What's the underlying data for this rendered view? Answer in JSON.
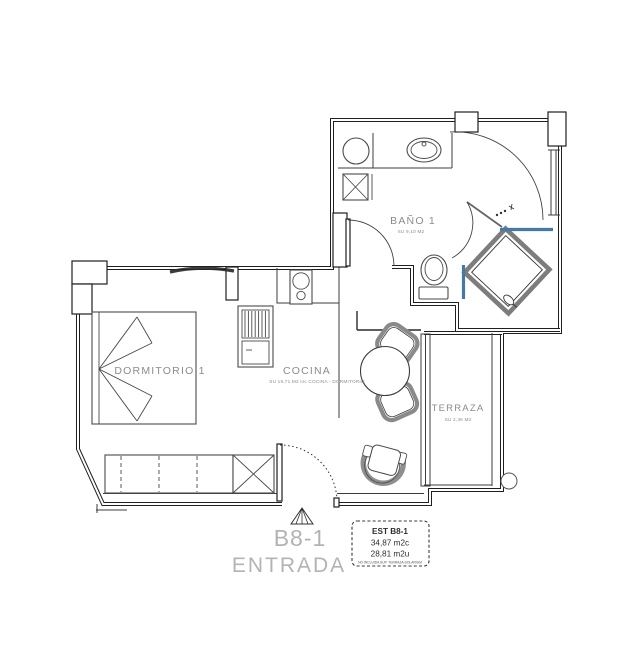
{
  "rooms": {
    "bano": {
      "name": "BAÑO 1",
      "area": "SU 9,10 M2"
    },
    "dormitorio": {
      "name": "DORMITORIO 1"
    },
    "cocina": {
      "name": "COCINA",
      "area": "SU 19,71 M2 inc COCINA - DORMITORIO"
    },
    "terraza": {
      "name": "TERRAZA",
      "area": "SU 2,36 M2"
    }
  },
  "entrance": {
    "unit": "B8-1",
    "label": "ENTRADA"
  },
  "info_box": {
    "title": "EST B8-1",
    "built_area": "34,87 m2c",
    "usable_area": "28,81 m2u",
    "note": "NO INCLUIDA SUP. TERRAZA-SOLARIUM"
  },
  "colors": {
    "wall": "#1f1f1f",
    "glass_blue": "#4479a8",
    "furniture_gray": "#8a8a8a",
    "label_gray": "#8c8c8c",
    "entrance_gray": "#b3b3b3"
  },
  "fixtures": [
    "washing-machine",
    "bathroom-sink",
    "toilet",
    "shower",
    "bed",
    "wardrobe",
    "closet",
    "refrigerator",
    "cooktop",
    "dining-table",
    "dining-chair",
    "armchair",
    "sliding-door",
    "entrance-door",
    "entrance-marker"
  ]
}
